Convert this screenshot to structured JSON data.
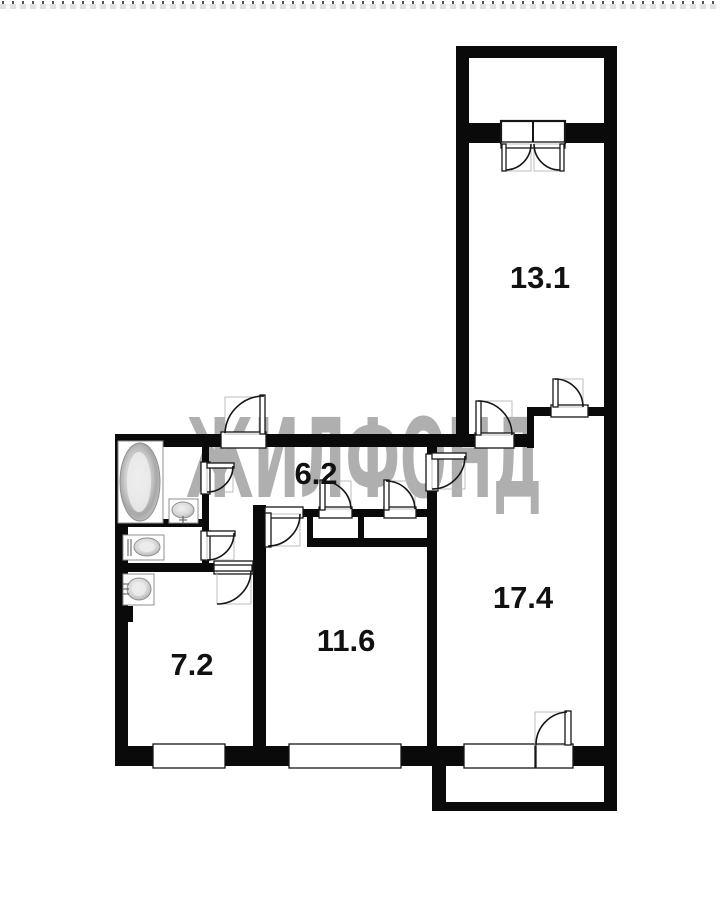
{
  "meta": {
    "type": "apartment-floor-plan"
  },
  "colors": {
    "wall": "#0a0a0a",
    "line": "#161616",
    "faint": "#b5b5b5",
    "fixture_stroke": "#8f8f8f",
    "watermark": "#afafaf",
    "label": "#111111",
    "background": "#ffffff"
  },
  "watermark": {
    "text": "ЖИЛФОНД"
  },
  "rooms": [
    {
      "name": "room-13-1",
      "label": "13.1",
      "area": 13.1,
      "cx": 540,
      "cy": 277
    },
    {
      "name": "hallway-6-2",
      "label": "6.2",
      "area": 6.2,
      "cx": 316,
      "cy": 473
    },
    {
      "name": "room-17-4",
      "label": "17.4",
      "area": 17.4,
      "cx": 523,
      "cy": 597
    },
    {
      "name": "room-11-6",
      "label": "11.6",
      "area": 11.6,
      "cx": 346,
      "cy": 640
    },
    {
      "name": "room-7-2",
      "label": "7.2",
      "area": 7.2,
      "cx": 192,
      "cy": 664
    }
  ],
  "walls": [
    {
      "name": "balcony-top",
      "r": [
        456,
        46,
        161,
        12
      ]
    },
    {
      "name": "balcony-left",
      "r": [
        456,
        46,
        13,
        87
      ]
    },
    {
      "name": "balcony-divider",
      "r": [
        456,
        123,
        161,
        20
      ]
    },
    {
      "name": "room131-left",
      "r": [
        456,
        121,
        13,
        326
      ]
    },
    {
      "name": "outer-right",
      "r": [
        604,
        46,
        13,
        765
      ]
    },
    {
      "name": "top-main",
      "r": [
        115,
        434,
        419,
        13
      ]
    },
    {
      "name": "nook-top",
      "r": [
        527,
        407,
        90,
        9
      ]
    },
    {
      "name": "nook-connector",
      "r": [
        527,
        407,
        7,
        41
      ]
    },
    {
      "name": "outer-left",
      "r": [
        115,
        434,
        13,
        332
      ]
    },
    {
      "name": "outer-bottom",
      "r": [
        115,
        746,
        502,
        20
      ]
    },
    {
      "name": "bath-hall",
      "r": [
        202,
        447,
        7,
        119
      ]
    },
    {
      "name": "bath-toilet",
      "r": [
        115,
        519,
        87,
        8
      ]
    },
    {
      "name": "room72-top",
      "r": [
        115,
        563,
        150,
        9
      ]
    },
    {
      "name": "room72-right",
      "r": [
        253,
        505,
        13,
        248
      ]
    },
    {
      "name": "hall-bottom",
      "r": [
        262,
        509,
        175,
        8
      ]
    },
    {
      "name": "closet-left",
      "r": [
        307,
        509,
        6,
        37
      ]
    },
    {
      "name": "closet-divider",
      "r": [
        358,
        509,
        6,
        37
      ]
    },
    {
      "name": "room116-top",
      "r": [
        307,
        538,
        130,
        9
      ]
    },
    {
      "name": "rooms-divider",
      "r": [
        427,
        447,
        10,
        306
      ]
    },
    {
      "name": "wall-stub",
      "r": [
        115,
        606,
        18,
        16
      ]
    },
    {
      "name": "balcony2-left",
      "r": [
        432,
        766,
        14,
        45
      ]
    },
    {
      "name": "balcony2-bottom",
      "r": [
        432,
        802,
        185,
        9
      ]
    }
  ],
  "openings": [
    {
      "name": "balcony-window-unit",
      "r": [
        501,
        121,
        64,
        22
      ],
      "bold": true,
      "divider": true
    },
    {
      "name": "balcony-window-sill",
      "r": [
        501,
        142,
        64,
        6
      ]
    },
    {
      "name": "nook-door-opening",
      "r": [
        551,
        405,
        37,
        12
      ]
    },
    {
      "name": "room131-door-opening",
      "r": [
        475,
        433,
        39,
        15
      ]
    },
    {
      "name": "entry-door-opening",
      "r": [
        221,
        432,
        45,
        16
      ]
    },
    {
      "name": "bathroom-door-opening",
      "r": [
        201,
        462,
        9,
        32
      ]
    },
    {
      "name": "toilet-door-opening",
      "r": [
        201,
        531,
        9,
        29
      ]
    },
    {
      "name": "room72-door-opening",
      "r": [
        214,
        561,
        39,
        13
      ]
    },
    {
      "name": "room116-door-opening",
      "r": [
        265,
        507,
        38,
        11
      ]
    },
    {
      "name": "closet-a-door-opening",
      "r": [
        319,
        507,
        33,
        11
      ]
    },
    {
      "name": "closet-b-door-opening",
      "r": [
        384,
        507,
        32,
        11
      ]
    },
    {
      "name": "room174-door-opening",
      "r": [
        426,
        454,
        12,
        37
      ]
    },
    {
      "name": "window-room72",
      "r": [
        153,
        744,
        72,
        24
      ]
    },
    {
      "name": "window-room116",
      "r": [
        289,
        744,
        112,
        24
      ]
    },
    {
      "name": "window-room174",
      "r": [
        464,
        744,
        71,
        24
      ]
    },
    {
      "name": "balcony2-door-opening",
      "r": [
        536,
        744,
        37,
        24
      ]
    }
  ],
  "doors": [
    {
      "name": "balcony-door-left",
      "leaf": [
        502,
        144,
        4,
        27
      ],
      "box": [
        504,
        144,
        27,
        27
      ],
      "arc": [
        506,
        170,
        26,
        0,
        531,
        144
      ]
    },
    {
      "name": "balcony-door-right",
      "leaf": [
        560,
        144,
        4,
        27
      ],
      "box": [
        534,
        144,
        27,
        27
      ],
      "arc": [
        560,
        170,
        26,
        1,
        534,
        144
      ]
    },
    {
      "name": "nook-door",
      "leaf": [
        553,
        379,
        5,
        28
      ],
      "box": [
        555,
        379,
        28,
        28
      ],
      "arc": [
        555,
        379,
        28,
        1,
        583,
        407
      ]
    },
    {
      "name": "room131-door",
      "leaf": [
        476,
        401,
        5,
        34
      ],
      "box": [
        478,
        401,
        34,
        34
      ],
      "arc": [
        478,
        401,
        34,
        1,
        512,
        435
      ]
    },
    {
      "name": "entry-door",
      "leaf": [
        260,
        395,
        5,
        39
      ],
      "box": [
        225,
        397,
        40,
        37
      ],
      "arc": [
        225,
        433,
        39,
        1,
        264,
        396
      ]
    },
    {
      "name": "bathroom-door",
      "leaf": [
        207,
        463,
        27,
        5
      ],
      "box": [
        207,
        466,
        26,
        26
      ],
      "arc": [
        233,
        466,
        26,
        1,
        207,
        492
      ]
    },
    {
      "name": "toilet-door",
      "leaf": [
        207,
        531,
        28,
        5
      ],
      "box": [
        207,
        534,
        27,
        26
      ],
      "arc": [
        234,
        533,
        27,
        1,
        207,
        560
      ]
    },
    {
      "name": "room72-door",
      "leaf": [
        214,
        565,
        38,
        6
      ],
      "box": [
        217,
        570,
        34,
        34
      ],
      "arc": [
        251,
        571,
        34,
        1,
        217,
        604
      ]
    },
    {
      "name": "room116-door",
      "leaf": [
        265,
        513,
        6,
        34
      ],
      "box": [
        268,
        514,
        32,
        32
      ],
      "arc": [
        300,
        514,
        32,
        1,
        268,
        546
      ]
    },
    {
      "name": "closet-a-door",
      "leaf": [
        320,
        480,
        5,
        30
      ],
      "box": [
        322,
        481,
        29,
        28
      ],
      "arc": [
        322,
        481,
        29,
        1,
        351,
        509
      ]
    },
    {
      "name": "closet-b-door",
      "leaf": [
        384,
        480,
        5,
        30
      ],
      "box": [
        386,
        481,
        29,
        28
      ],
      "arc": [
        386,
        481,
        29,
        1,
        415,
        509
      ]
    },
    {
      "name": "room174-door",
      "leaf": [
        432,
        453,
        34,
        6
      ],
      "box": [
        432,
        456,
        33,
        33
      ],
      "arc": [
        465,
        456,
        33,
        1,
        432,
        489
      ]
    },
    {
      "name": "balcony2-door",
      "leaf": [
        565,
        711,
        6,
        34
      ],
      "box": [
        535,
        712,
        33,
        33
      ],
      "arc": [
        567,
        712,
        33,
        0,
        536,
        745
      ]
    }
  ],
  "fixtures": [
    {
      "name": "bathtub",
      "surround": [
        118,
        441,
        45,
        82
      ],
      "oval": [
        140,
        482,
        20,
        39
      ],
      "inner": [
        139,
        482,
        12,
        30
      ]
    },
    {
      "name": "bathroom-sink",
      "surround": [
        169,
        499,
        29,
        24
      ],
      "oval": [
        183,
        510,
        11,
        8
      ],
      "lines": [
        [
          183,
          516,
          183,
          524
        ],
        [
          179,
          520,
          187,
          520
        ]
      ]
    },
    {
      "name": "toilet",
      "surround": [
        123,
        535,
        41,
        25
      ],
      "oval": [
        147,
        547,
        13,
        9
      ],
      "inner": [
        147,
        547,
        8,
        5
      ],
      "lines": [
        [
          128,
          539,
          128,
          556
        ],
        [
          131,
          539,
          131,
          556
        ]
      ]
    },
    {
      "name": "washbasin",
      "surround": [
        123,
        574,
        31,
        31
      ],
      "oval": [
        139,
        589,
        12,
        11
      ],
      "inner": [
        139,
        589,
        7,
        7
      ],
      "lines": [
        [
          123,
          584,
          129,
          584
        ],
        [
          123,
          589,
          129,
          589
        ],
        [
          123,
          594,
          129,
          594
        ]
      ]
    }
  ]
}
